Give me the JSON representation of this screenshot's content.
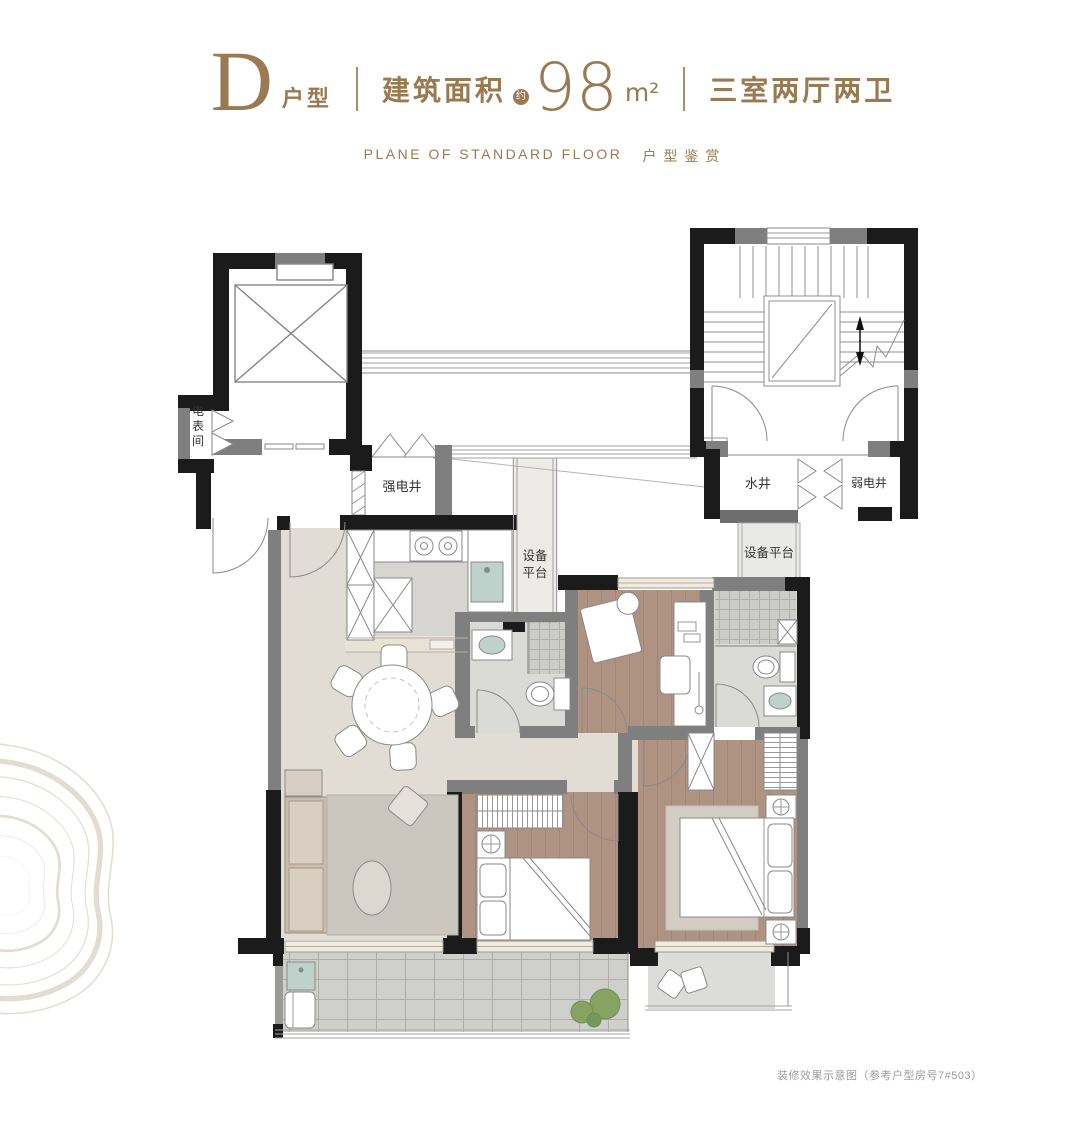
{
  "theme": {
    "accent": "#9a7a52",
    "wall_black": "#1b1b1b",
    "wall_gray": "#7f7f7f",
    "label_color": "#333333",
    "floor_living": "#e2ddd4",
    "floor_wood": "#ae9383",
    "floor_tile": "#cfcfcc",
    "fixture_teal": "#bed2cb"
  },
  "header": {
    "unit_letter": "D",
    "unit_suffix": "户型",
    "area_label": "建筑面积",
    "area_approx": "约",
    "area_value": "98",
    "area_unit": "m²",
    "layout": "三室两厅两卫",
    "subtitle_en": "PLANE OF STANDARD FLOOR",
    "subtitle_zh": "户型鉴赏"
  },
  "plan": {
    "labels": {
      "meter_room": "电表间",
      "strong_electric_shaft": "强电井",
      "water_shaft": "水井",
      "weak_electric_shaft": "弱电井",
      "equipment_platform_side": "设备平台",
      "equipment_platform_top": "设备平台"
    }
  },
  "footnote": "装修效果示意图（参考户型房号7#503）"
}
